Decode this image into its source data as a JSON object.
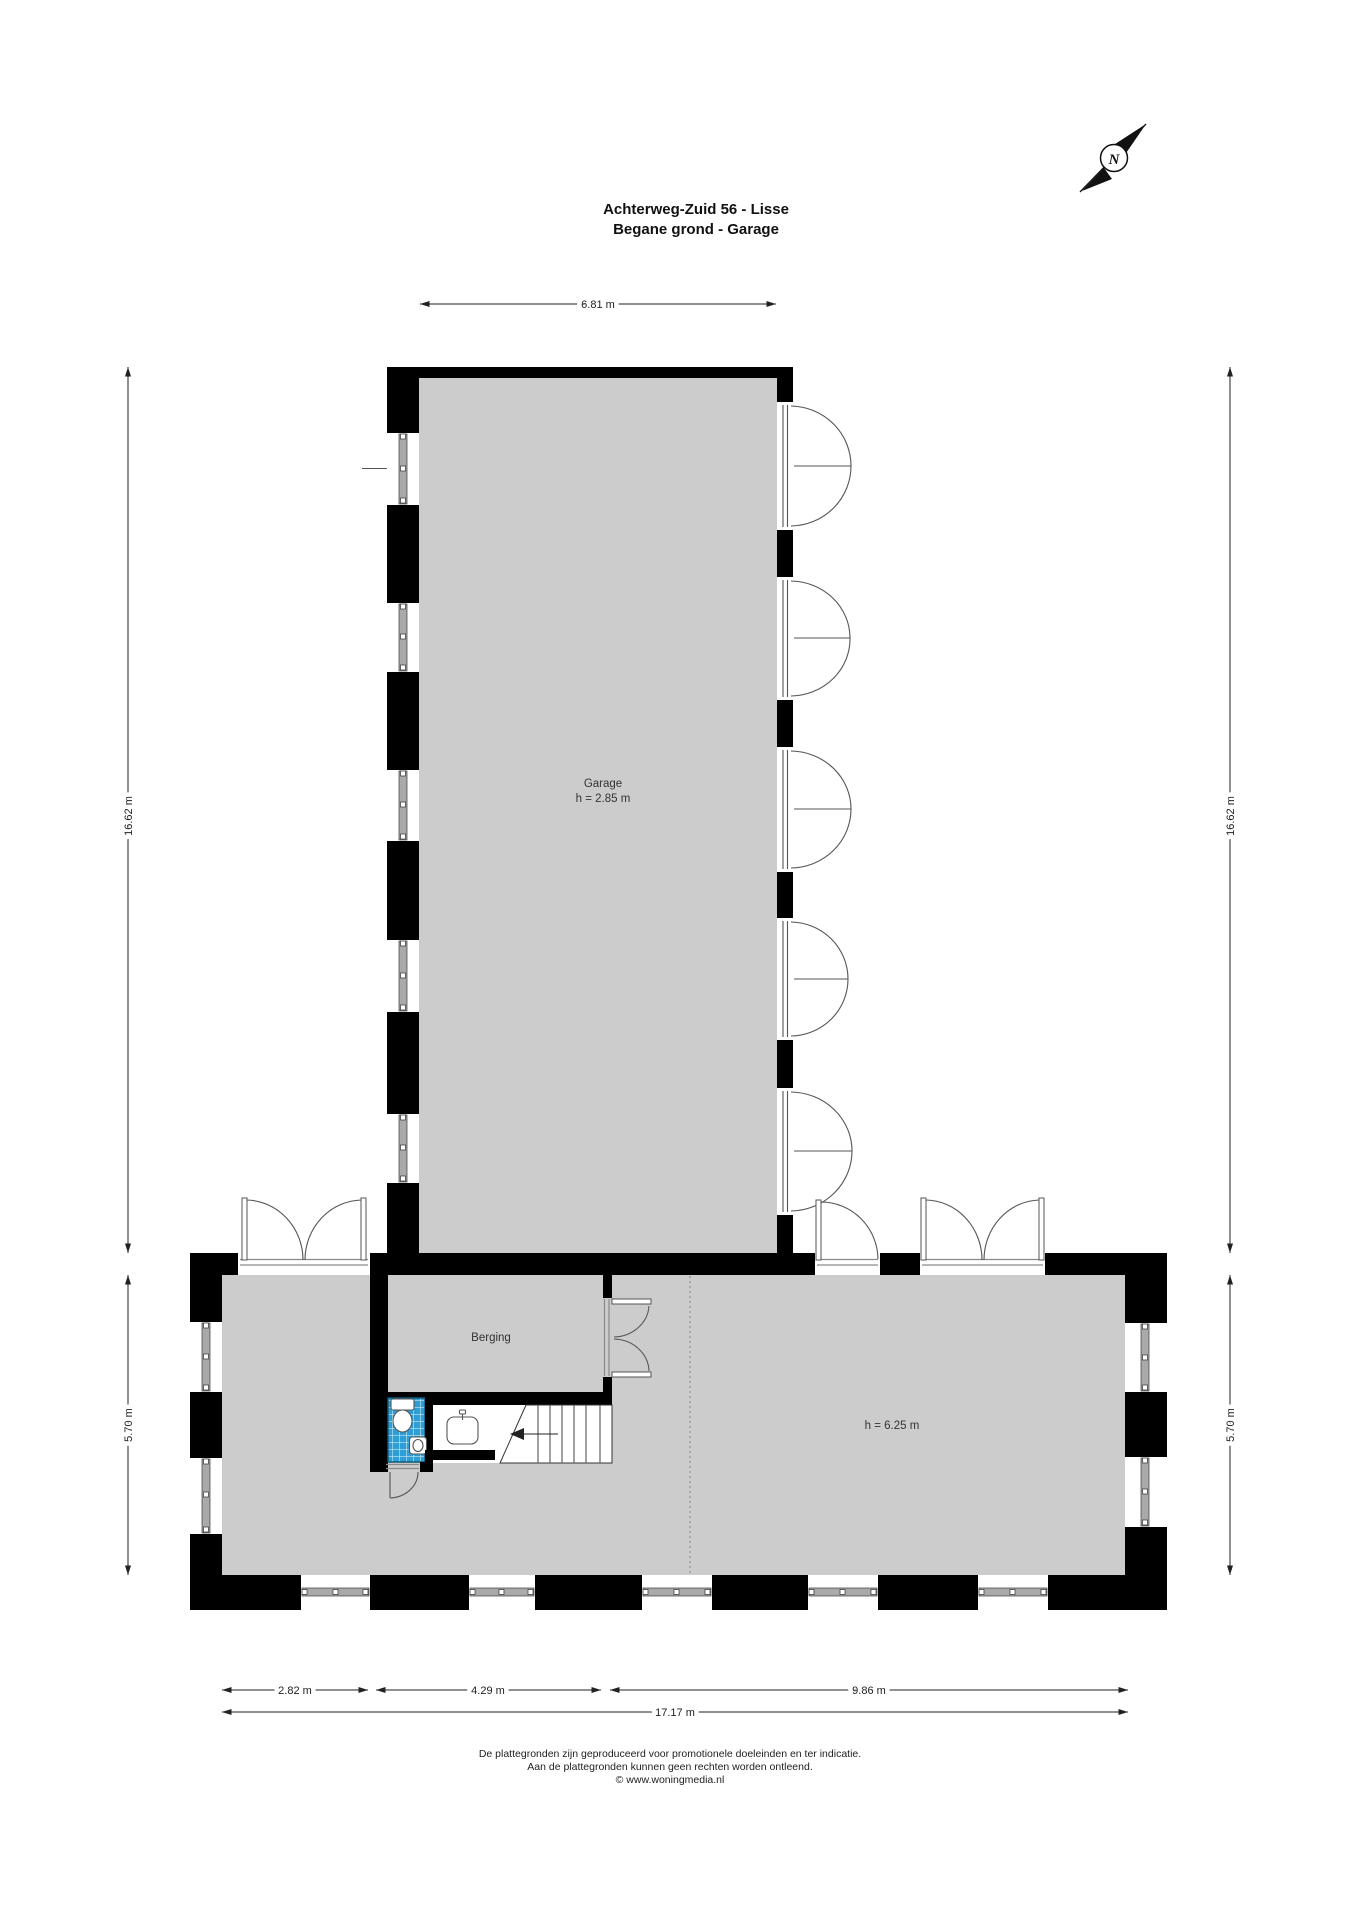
{
  "title": {
    "line1": "Achterweg-Zuid 56 - Lisse",
    "line2": "Begane grond - Garage"
  },
  "compass": {
    "north_letter": "N"
  },
  "rooms": {
    "garage": {
      "name": "Garage",
      "ceiling_height": "h = 2.85 m"
    },
    "berging": {
      "name": "Berging"
    },
    "main_hall": {
      "ceiling_height": "h = 6.25 m"
    }
  },
  "dimensions": {
    "top_width": "6.81 m",
    "left_upper_height": "16.62 m",
    "right_upper_height": "16.62 m",
    "left_lower_height": "5.70 m",
    "right_lower_height": "5.70 m",
    "bottom_segment_1": "2.82 m",
    "bottom_segment_2": "4.29 m",
    "bottom_segment_3": "9.86 m",
    "bottom_total": "17.17 m"
  },
  "footer": {
    "line1": "De plattegronden zijn geproduceerd voor promotionele doeleinden en ter indicatie.",
    "line2": "Aan de plattegronden kunnen geen rechten worden ontleend.",
    "line3": "© www.woningmedia.nl"
  },
  "colors": {
    "wall": "#000000",
    "floor": "#cccccc",
    "tile": "#2d9fd6",
    "tileborder": "#0e5a7a",
    "line": "#555555",
    "dim": "#222222",
    "text": "#111111"
  }
}
